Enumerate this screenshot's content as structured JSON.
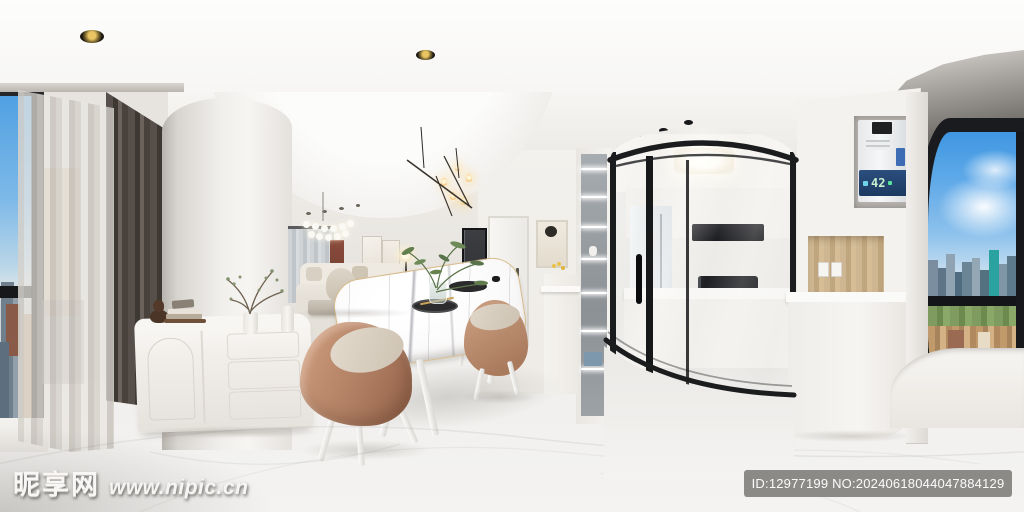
{
  "image": {
    "kind": "equirectangular-panorama-interior-render",
    "rooms": [
      "living-room",
      "dining-area",
      "kitchen",
      "balcony-windows"
    ],
    "width_px": 1024,
    "height_px": 512
  },
  "watermarks": {
    "site": {
      "name": "昵享网",
      "url": "www.nipic.cn"
    },
    "badge": {
      "text": "ID:12977199 NO:20240618044047884129",
      "background": "#7c7b78"
    }
  },
  "appliance_display": {
    "value": "42",
    "panel_color": "#24466f",
    "digit_color": "#c9f0cf"
  },
  "palette": {
    "ceiling": "#fbfbfa",
    "wall": "#eae7e3",
    "floor": "#f1f0ee",
    "curtain_dark": "#4a433d",
    "curtain_sheer": "#d8d4ce",
    "frame_black": "#1a1b1d",
    "sky": "#5aa7e4",
    "marble": "#fbfafa",
    "table_edge_gold": "#d8bd8e",
    "chair_tan": "#b98a6e",
    "chair_cushion": "#d9d0c3",
    "sofa": "#e8e3db",
    "wood_niche": "#c9b28e",
    "greenery": "#6d8b58"
  }
}
